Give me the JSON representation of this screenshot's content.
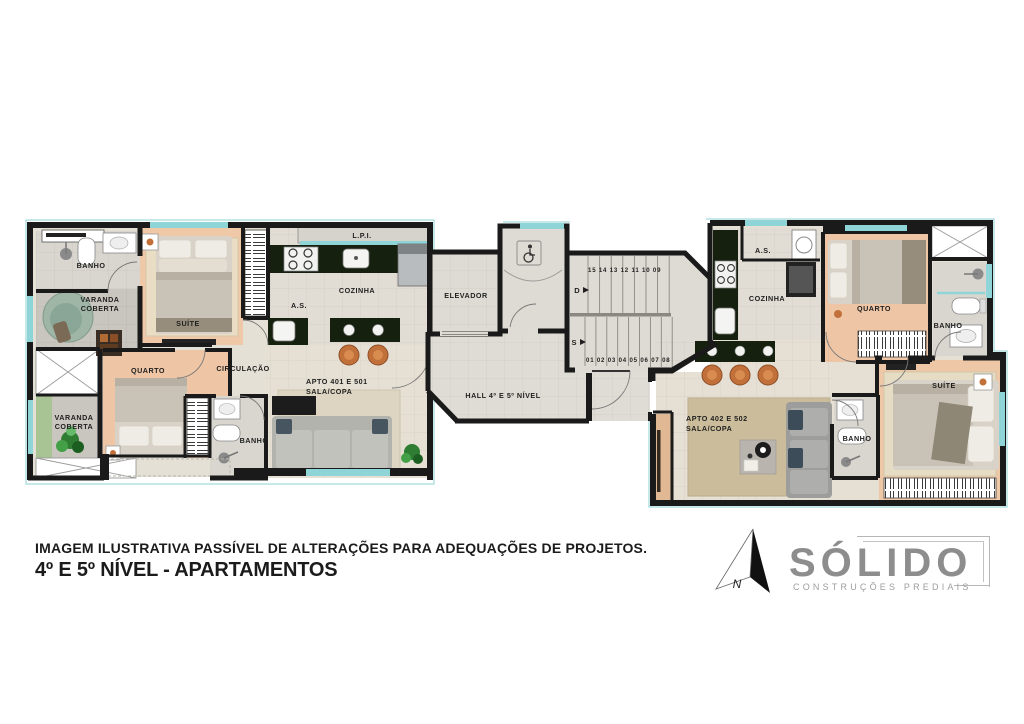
{
  "plan": {
    "apt1": {
      "banho": "BANHO",
      "varanda1_l1": "VARANDA",
      "varanda1_l2": "COBERTA",
      "suite": "SUÍTE",
      "lpi": "L.P.I.",
      "cozinha": "COZINHA",
      "as_label": "A.S.",
      "circulacao": "CIRCULAÇÃO",
      "quarto": "QUARTO",
      "varanda2_l1": "VARANDA",
      "varanda2_l2": "COBERTA",
      "banho2": "BANHO",
      "apto_l1": "APTO 401 E 501",
      "apto_l2": "SALA/COPA"
    },
    "core": {
      "elevador": "ELEVADOR",
      "hall": "HALL 4º E 5º NÍVEL",
      "stairs_up": "15 14 13 12 11 10 09",
      "stairs_down": "01 02 03 04 05 06 07 08",
      "d": "D",
      "s": "S"
    },
    "apt2": {
      "as_label": "A.S.",
      "cozinha": "COZINHA",
      "quarto": "QUARTO",
      "banho1": "BANHO",
      "apto_l1": "APTO 402 E 502",
      "apto_l2": "SALA/COPA",
      "banho2": "BANHO",
      "suite": "SUÍTE"
    }
  },
  "footer": {
    "disclaimer": "IMAGEM ILUSTRATIVA PASSÍVEL DE ALTERAÇÕES PARA ADEQUAÇÕES DE PROJETOS.",
    "title": "4º E 5º NÍVEL - APARTAMENTOS"
  },
  "logo": {
    "north": "N",
    "brand": "SÓLIDO",
    "tagline": "CONSTRUÇÕES PREDIAIS"
  },
  "colors": {
    "wall": "#1a1a1a",
    "window": "#8fd4d6",
    "wood_floor": "#eec7a6",
    "counter": "#15200f",
    "stool": "#c2703a",
    "logo_gray": "#8d8d8d"
  }
}
